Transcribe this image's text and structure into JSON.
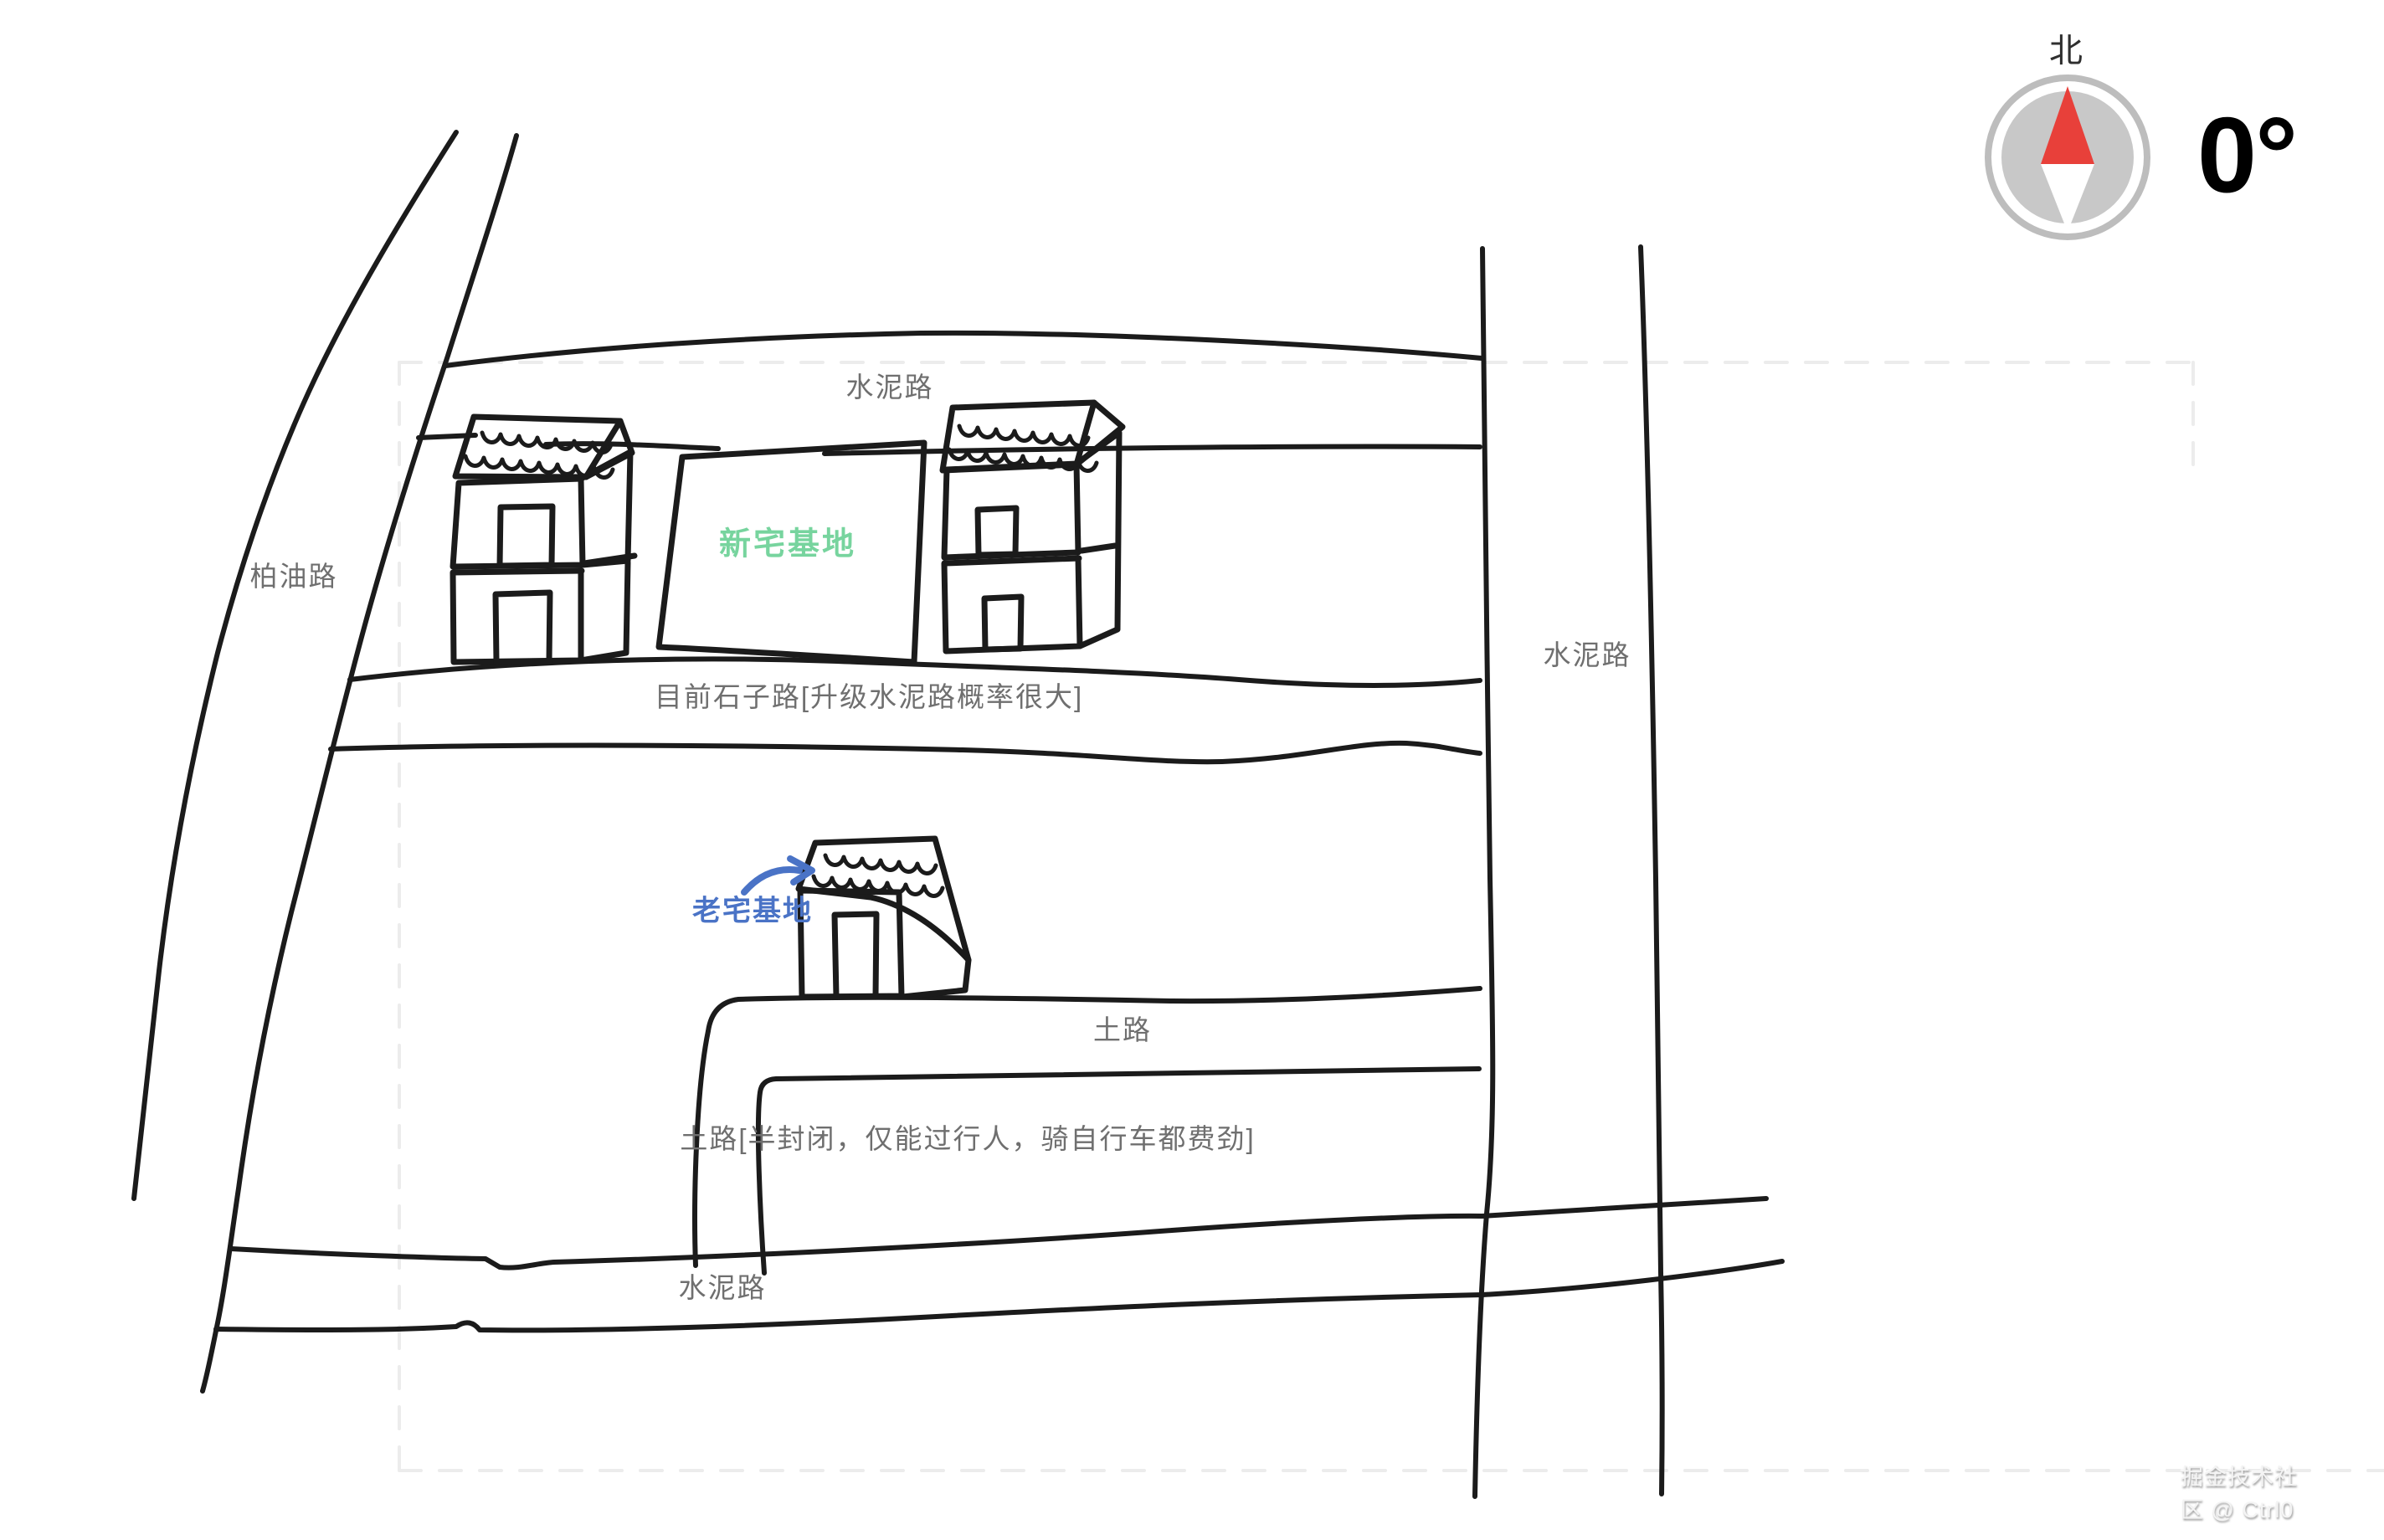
{
  "compass": {
    "north_label": "北",
    "bearing": "0°"
  },
  "map": {
    "labels": {
      "top_road": "水泥路",
      "left_road": "柏油路",
      "new_plot": "新宅基地",
      "right_road": "水泥路",
      "gravel_road": "目前石子路[升级水泥路概率很大]",
      "old_plot": "老宅基地",
      "dirt_road": "土路",
      "dirt_road_note": "土路[半封闭，仅能过行人，骑自行车都费劲]",
      "bottom_road": "水泥路"
    }
  },
  "watermark": "掘金技术社区 @ Ctrl0",
  "colors": {
    "ink": "#1b1b1b",
    "label_gray": "#6f6f6f",
    "new_plot_green": "#77d49e",
    "old_plot_blue": "#4a73c6",
    "compass_needle_red": "#e8403a",
    "compass_dial_gray": "#c8c8c8",
    "dashed_boundary_gray": "#ececec"
  }
}
